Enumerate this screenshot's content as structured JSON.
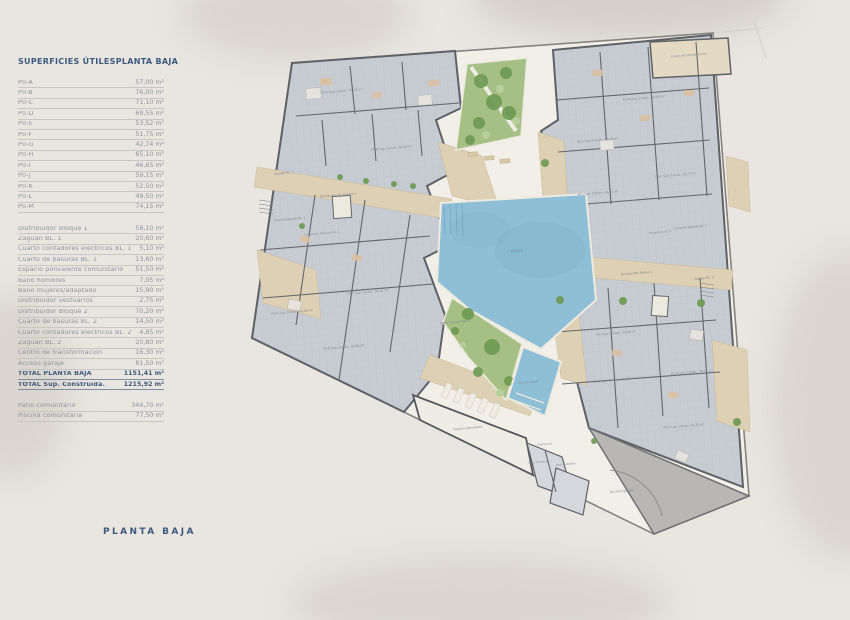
{
  "table": {
    "title_left": "SUPERFICIES ÚTILES",
    "title_right": "PLANTA BAJA",
    "units": [
      {
        "label": "P0-A",
        "value": "57,00 m²"
      },
      {
        "label": "P0-B",
        "value": "76,00 m²"
      },
      {
        "label": "P0-C",
        "value": "71,10 m²"
      },
      {
        "label": "P0-D",
        "value": "69,55 m²"
      },
      {
        "label": "P0-E",
        "value": "53,52 m²"
      },
      {
        "label": "P0-F",
        "value": "51,75 m²"
      },
      {
        "label": "P0-G",
        "value": "42,74 m²"
      },
      {
        "label": "P0-H",
        "value": "65,10 m²"
      },
      {
        "label": "P0-I",
        "value": "46,65 m²"
      },
      {
        "label": "P0-J",
        "value": "59,15 m²"
      },
      {
        "label": "P0-K",
        "value": "52,50 m²"
      },
      {
        "label": "P0-L",
        "value": "49,50 m²"
      },
      {
        "label": "P0-M",
        "value": "74,15 m²"
      }
    ],
    "commons": [
      {
        "label": "Distribuidor Bloque 1",
        "value": "58,10 m²"
      },
      {
        "label": "Zaguán BL. 1",
        "value": "20,60 m²"
      },
      {
        "label": "Cuarto contadores eléctricos BL. 1",
        "value": "5,10 m²"
      },
      {
        "label": "Cuarto de basuras BL. 1",
        "value": "13,60 m²"
      },
      {
        "label": "Espacio polivalente comunitario",
        "value": "51,50 m²"
      },
      {
        "label": "Baño hombres",
        "value": "7,05 m²"
      },
      {
        "label": "Baño mujeres/adaptado",
        "value": "15,90 m²"
      },
      {
        "label": "Distribuidor vestuarios",
        "value": "2,75 m²"
      },
      {
        "label": "Distribuidor Bloque 2",
        "value": "70,20 m²"
      },
      {
        "label": "Cuarto de basuras BL. 2",
        "value": "14,50 m²"
      },
      {
        "label": "Cuarto contadores eléctricos BL. 2",
        "value": "4,85 m²"
      },
      {
        "label": "Zaguán BL. 2",
        "value": "20,80 m²"
      },
      {
        "label": "Centro de transformación",
        "value": "16,30 m²"
      },
      {
        "label": "Acceso garaje",
        "value": "81,50 m²"
      },
      {
        "label": "TOTAL PLANTA BAJA",
        "value": "1151,41 m²",
        "emphasis": true
      },
      {
        "label": "TOTAL Sup. Construida.",
        "value": "1215,92 m²",
        "emphasis": true
      }
    ],
    "outdoor": [
      {
        "label": "Patio comunitario",
        "value": "344,70 m²"
      },
      {
        "label": "Piscina comunitaria",
        "value": "77,50 m²"
      }
    ]
  },
  "footer_label": "PLANTA BAJA",
  "plan": {
    "colors": {
      "accent": "#3d5a7d",
      "paper": "#e9e6e2",
      "courtyard": "#f2efe9",
      "block": "#c7ccd3",
      "wall": "#5e6165",
      "tan": "#ddd0b4",
      "green": "#a6bf85",
      "pool": "#8fbfd6",
      "ramp": "#b8b7b4"
    },
    "labels": [
      {
        "t": "P0-A Sup. Constr.: 67,65 m²",
        "x": 342,
        "y": 92
      },
      {
        "t": "P0-B Sup. Constr.: 82,55 m²",
        "x": 392,
        "y": 149
      },
      {
        "t": "P0-C Sup. Constr.: 85,42 m²",
        "x": 368,
        "y": 293
      },
      {
        "t": "P0-D Sup. Constr.: 70,00 m²",
        "x": 292,
        "y": 313
      },
      {
        "t": "P0-E Sup. Constr.: 59,80 m²",
        "x": 344,
        "y": 348
      },
      {
        "t": "Zaguán BL. 1",
        "x": 284,
        "y": 174
      },
      {
        "t": "Distribuidor BL Bloque 1",
        "x": 338,
        "y": 196
      },
      {
        "t": "Cuarto basuras BL. 1",
        "x": 290,
        "y": 220
      },
      {
        "t": "Contadores eléctricos BL. 1",
        "x": 322,
        "y": 234,
        "s": 2.6
      },
      {
        "t": "Centro de transformación",
        "x": 689,
        "y": 56,
        "s": 2.8
      },
      {
        "t": "P0-M Sup. Constr.: 56,89 m²",
        "x": 644,
        "y": 99
      },
      {
        "t": "P0-L Sup. Constr.: 85,00 m²",
        "x": 598,
        "y": 141
      },
      {
        "t": "P0-K Sup. Constr.: 59,77 m²",
        "x": 676,
        "y": 176
      },
      {
        "t": "P0-J Sup. Constr.: 64,00 m²",
        "x": 598,
        "y": 194
      },
      {
        "t": "Cuarto de basuras BL. 2",
        "x": 690,
        "y": 228,
        "s": 2.8
      },
      {
        "t": "Contadores BL. 2",
        "x": 660,
        "y": 233,
        "s": 2.6
      },
      {
        "t": "Distribuidor Bloque 2",
        "x": 637,
        "y": 274
      },
      {
        "t": "Zaguán BL. 2",
        "x": 704,
        "y": 279
      },
      {
        "t": "P0-I Sup. Constr.: 55,00 m²",
        "x": 616,
        "y": 334
      },
      {
        "t": "P0-G Sup. Constr.: 80,82 m²",
        "x": 614,
        "y": 381
      },
      {
        "t": "P0-H Sup. Constr.: 76,15 m²",
        "x": 692,
        "y": 373
      },
      {
        "t": "P0-F Sup. Constr.: 61,25 m²",
        "x": 684,
        "y": 427
      },
      {
        "t": "Piscina",
        "x": 517,
        "y": 252,
        "c": "#6d95aa",
        "s": 3.4
      },
      {
        "t": "Piscina infantil",
        "x": 529,
        "y": 383,
        "c": "#6d95aa",
        "s": 2.8
      },
      {
        "t": "Patio comunitario",
        "x": 455,
        "y": 323,
        "s": 3.4
      },
      {
        "t": "Espacio polivalente",
        "x": 468,
        "y": 429
      },
      {
        "t": "Distribuidor",
        "x": 545,
        "y": 445,
        "s": 2.6
      },
      {
        "t": "Baño hombres",
        "x": 538,
        "y": 463,
        "s": 2.6
      },
      {
        "t": "Baño adaptado",
        "x": 566,
        "y": 465,
        "s": 2.6
      },
      {
        "t": "Acceso garaje",
        "x": 622,
        "y": 492,
        "s": 3.4
      }
    ]
  }
}
